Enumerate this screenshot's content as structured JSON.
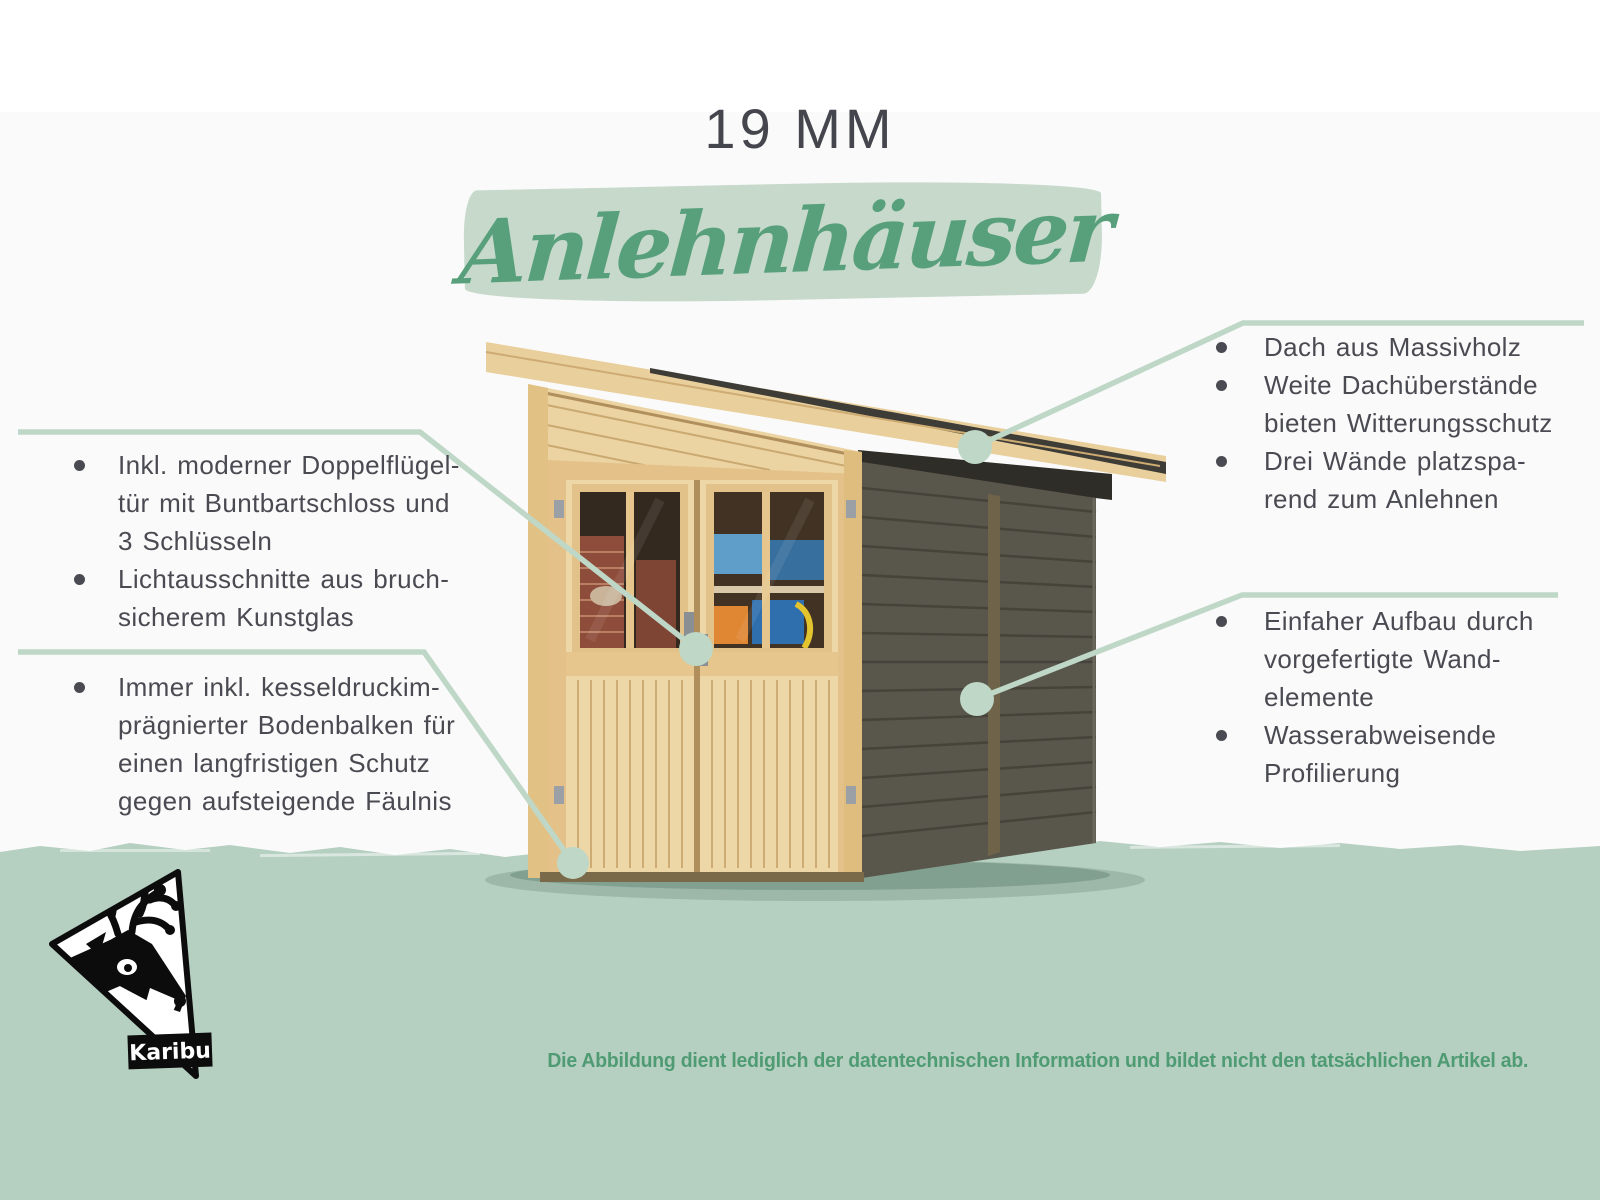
{
  "header": {
    "size_label": "19 MM",
    "category_title": "Anlehnhäuser"
  },
  "callouts": {
    "left_top": {
      "items": [
        "Inkl. moderner Doppelflügel-\ntür mit Buntbartschloss und\n3 Schlüsseln",
        "Lichtausschnitte aus bruch-\nsicherem Kunstglas"
      ]
    },
    "left_bottom": {
      "items": [
        "Immer inkl. kesseldruckim-\nprägnierter Bodenbalken für\neinen langfristigen Schutz\ngegen aufsteigende Fäulnis"
      ]
    },
    "right_top": {
      "items": [
        "Dach aus Massivholz",
        "Weite Dachüberstände\nbieten Witterungsschutz",
        "Drei Wände platzspa-\nrend zum Anlehnen"
      ]
    },
    "right_bottom": {
      "items": [
        "Einfaher Aufbau durch\nvorgefertigte Wand-\nelemente",
        "Wasserabweisende\nProfilierung"
      ]
    }
  },
  "logo": {
    "brand": "Karibu"
  },
  "footer": {
    "disclaimer": "Die Abbildung dient lediglich der datentechnischen Information und bildet nicht den tatsächlichen Artikel ab."
  },
  "illustration": {
    "description": "Lean-to garden shed (Anlehnhaus): natural wood front with glazed double doors, dark grey side wall, single-pitch solid wood roof"
  },
  "colors": {
    "accent_green": "#58a07c",
    "mint_brush": "#c6d9cb",
    "callout_line": "#bed7c7",
    "band_green": "#b5cfc0",
    "text_dark": "#4a4a52",
    "disclaimer_green": "#4f9b73"
  }
}
